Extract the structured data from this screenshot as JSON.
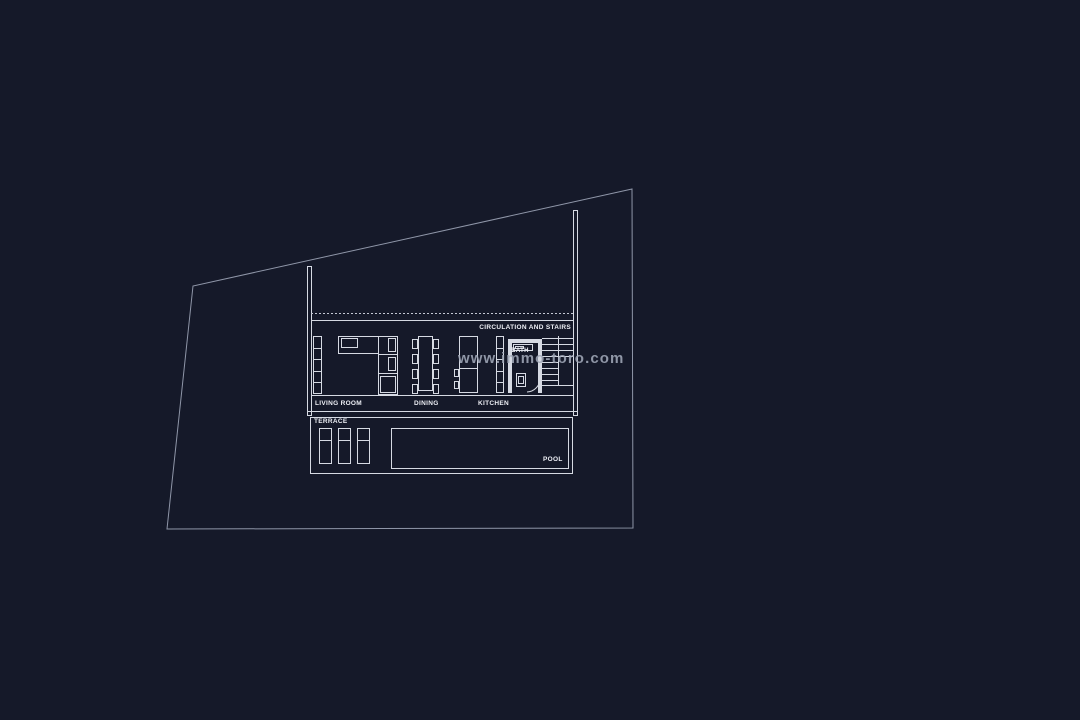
{
  "watermark": {
    "text": "www.immo-toro.com"
  },
  "plan": {
    "labels": {
      "circulation_and_stairs": "CIRCULATION AND STAIRS",
      "bath": "BATH",
      "living_room": "LIVING ROOM",
      "dining": "DINING",
      "kitchen": "KITCHEN",
      "terrace": "TERRACE",
      "pool": "POOL"
    }
  },
  "colors": {
    "background": "#151929",
    "plan_line": "#d6dae3",
    "boundary_line": "#8f96a8",
    "label_text": "#edeff5",
    "watermark_text": "#9aa1b3"
  }
}
